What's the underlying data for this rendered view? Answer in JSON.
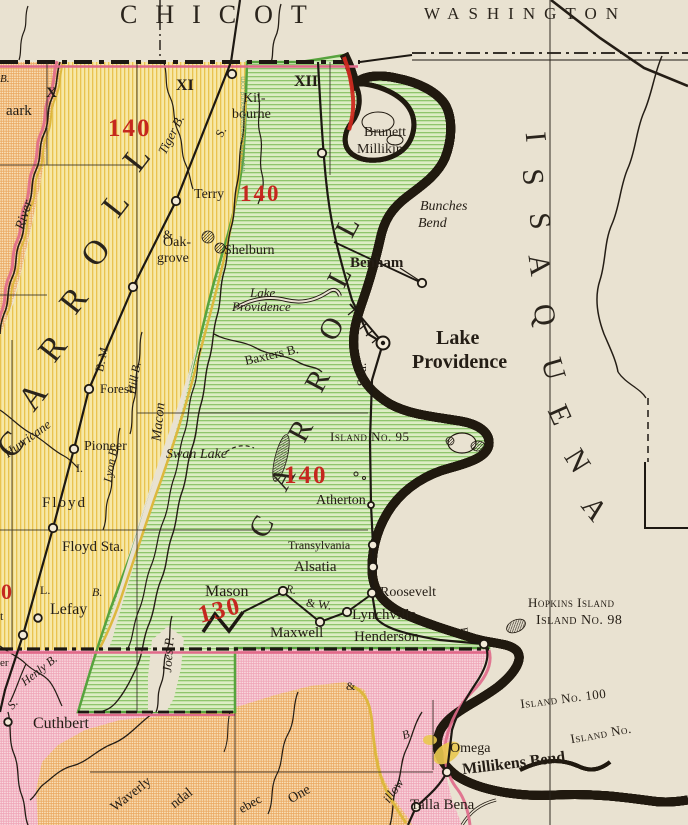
{
  "colors": {
    "paper": "#e9e2d1",
    "east_carroll_green": "#dcedc4",
    "green_stripe": "#8fc56c",
    "west_carroll_yellow": "#f7e8a6",
    "yellow_stripe": "#e9c34f",
    "arkansas_orange": "#f8e2bb",
    "orange_hatch": "#eaa65e",
    "madison_pink": "#f8d9de",
    "pink_hatch": "#efa3b6",
    "boundary_rose": "#e06a8a",
    "red_figures": "#c5271f",
    "ink": "#241d15"
  },
  "counties": {
    "chicot": "CHICOT",
    "washington": "WASHINGTON"
  },
  "county_letters": {
    "issaquena": [
      "I",
      "S",
      "S",
      "A",
      "Q",
      "U",
      "E",
      "N",
      "A"
    ],
    "east_carroll": [
      "C",
      "A",
      "R",
      "R",
      "O",
      "L",
      "L"
    ],
    "west_carroll": [
      "C",
      "A",
      "R",
      "R",
      "O",
      "L",
      "L"
    ]
  },
  "numerals": {
    "x": "X",
    "xi": "XI",
    "xii": "XII"
  },
  "figures": {
    "f140_nw": "140",
    "f140_n": "140",
    "f140_c": "140",
    "f130": "130",
    "f0": "0"
  },
  "towns": {
    "aark_partial": "aark",
    "kilbourne_1": "Kil-",
    "kilbourne_2": "bourne",
    "terry": "Terry",
    "brunett_1": "Brunett",
    "brunett_2": "Millikin",
    "oakgrove_1": "Oak-",
    "oakgrove_2": "grove",
    "shelburn": "Shelburn",
    "benham": "Benham",
    "lake_providence_1": "Lake",
    "lake_providence_2": "Providence",
    "forest": "Forest",
    "pioneer": "Pioneer",
    "floyd": "Floyd",
    "floyd_sta": "Floyd Sta.",
    "atherton": "Atherton",
    "transylvania": "Transylvania",
    "alsatia": "Alsatia",
    "mason": "Mason",
    "maxwell": "Maxwell",
    "roosevelt": "Roosevelt",
    "lynchville": "Lynchville",
    "henderson": "Henderson",
    "omega": "Omega",
    "millikens_bend": "Millikens Bend",
    "talla_bena": "Talla Bena",
    "cuthbert": "Cuthbert",
    "lefay": "Lefay",
    "waverly": "Waverly",
    "ndal_partial": "ndal",
    "ebec_partial": "ebec",
    "one_partial": "One",
    "er_partial": "er",
    "t_partial": "t"
  },
  "water": {
    "bunches_1": "Bunches",
    "bunches_2": "Bend",
    "lp_lake_1": "Lake",
    "lp_lake_2": "Providence",
    "swan_lake": "Swan Lake",
    "baxters": "Baxters B.",
    "tiger": "Tiger B.",
    "river": "River",
    "hill": "Hill B.",
    "macon": "Macon",
    "hurricane": "Hurricane",
    "lyon": "Lyon B.",
    "joes": "Joes P.",
    "henly": "Henly B.",
    "willow_partial": "illow",
    "willow_b": "B.",
    "b_top": "B.",
    "b_lefay": "B.",
    "s_left": "S.",
    "l_left": "L.",
    "i_left": "I."
  },
  "islands": {
    "island_95": "Island No. 95",
    "hopkins": "Hopkins Island",
    "island_98": "Island No. 98",
    "island_100": "Island No. 100",
    "island_partial": "Island No."
  },
  "railroads": {
    "sou": "Sou.",
    "s_upper": "S.",
    "b_m": "B. M.",
    "r_dot": "R.",
    "and_w": "& W.",
    "amp_oak": "&",
    "amp_south": "&",
    "r_henderson": "R"
  },
  "watermark": "www.MyGenealogyHound.com"
}
